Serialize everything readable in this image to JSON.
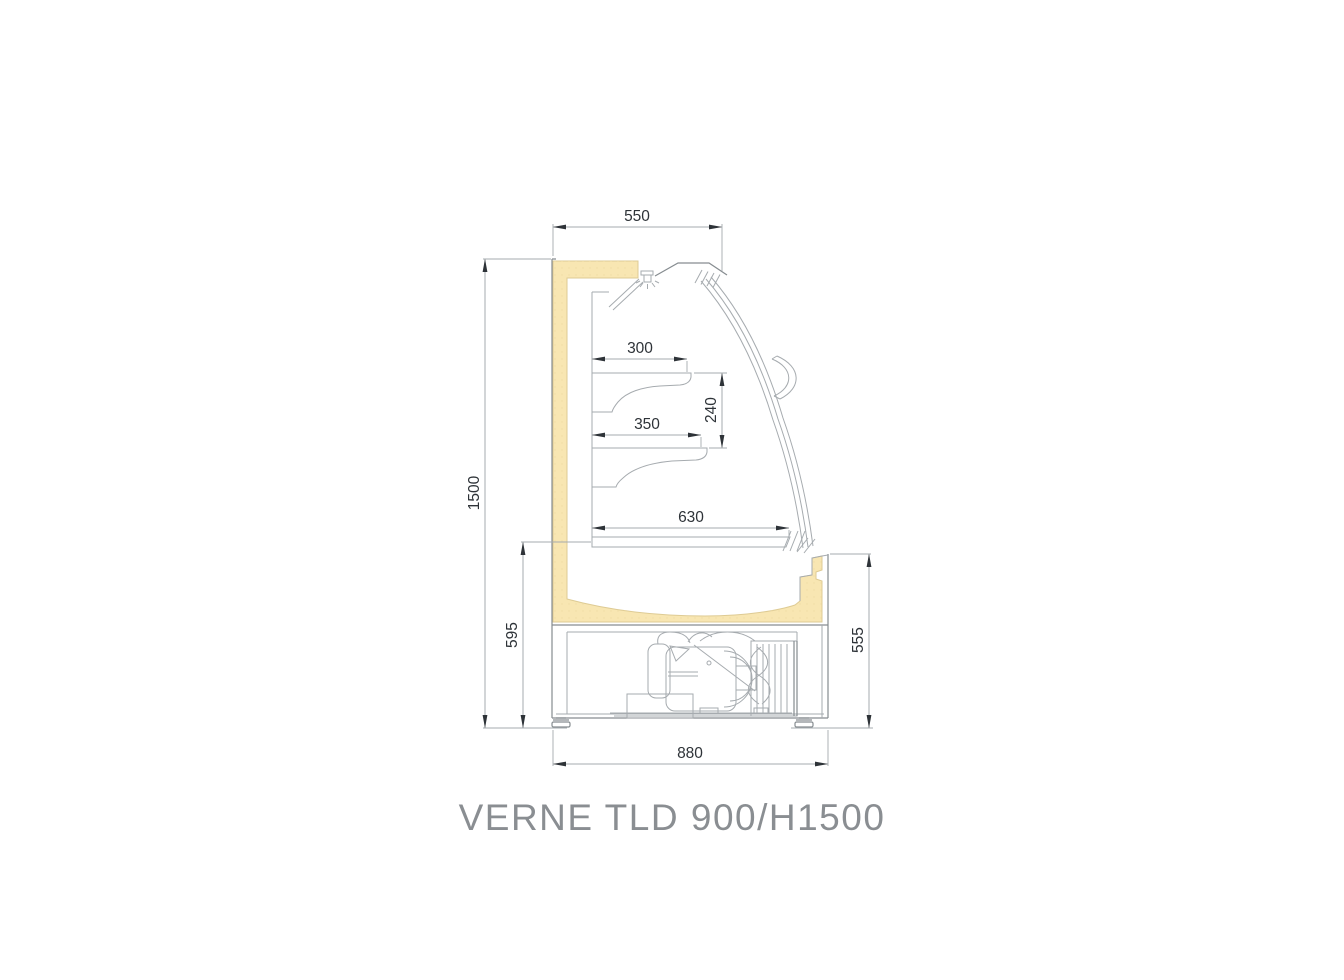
{
  "title": "VERNE TLD 900/H1500",
  "dimensions_mm": {
    "canopy_depth": "550",
    "overall_height": "1500",
    "upper_shelf_depth": "300",
    "shelf_spacing": "240",
    "lower_shelf_depth": "350",
    "deck_depth": "630",
    "base_height_left": "595",
    "base_height_right": "555",
    "base_depth": "880"
  },
  "colors": {
    "insulation": "#F8E6B2",
    "insulation_border": "#DECB94",
    "line": "#A6ABAF",
    "outline": "#868C90",
    "dark": "#2E3338",
    "title": "#8A8E92",
    "background": "#FFFFFF"
  }
}
